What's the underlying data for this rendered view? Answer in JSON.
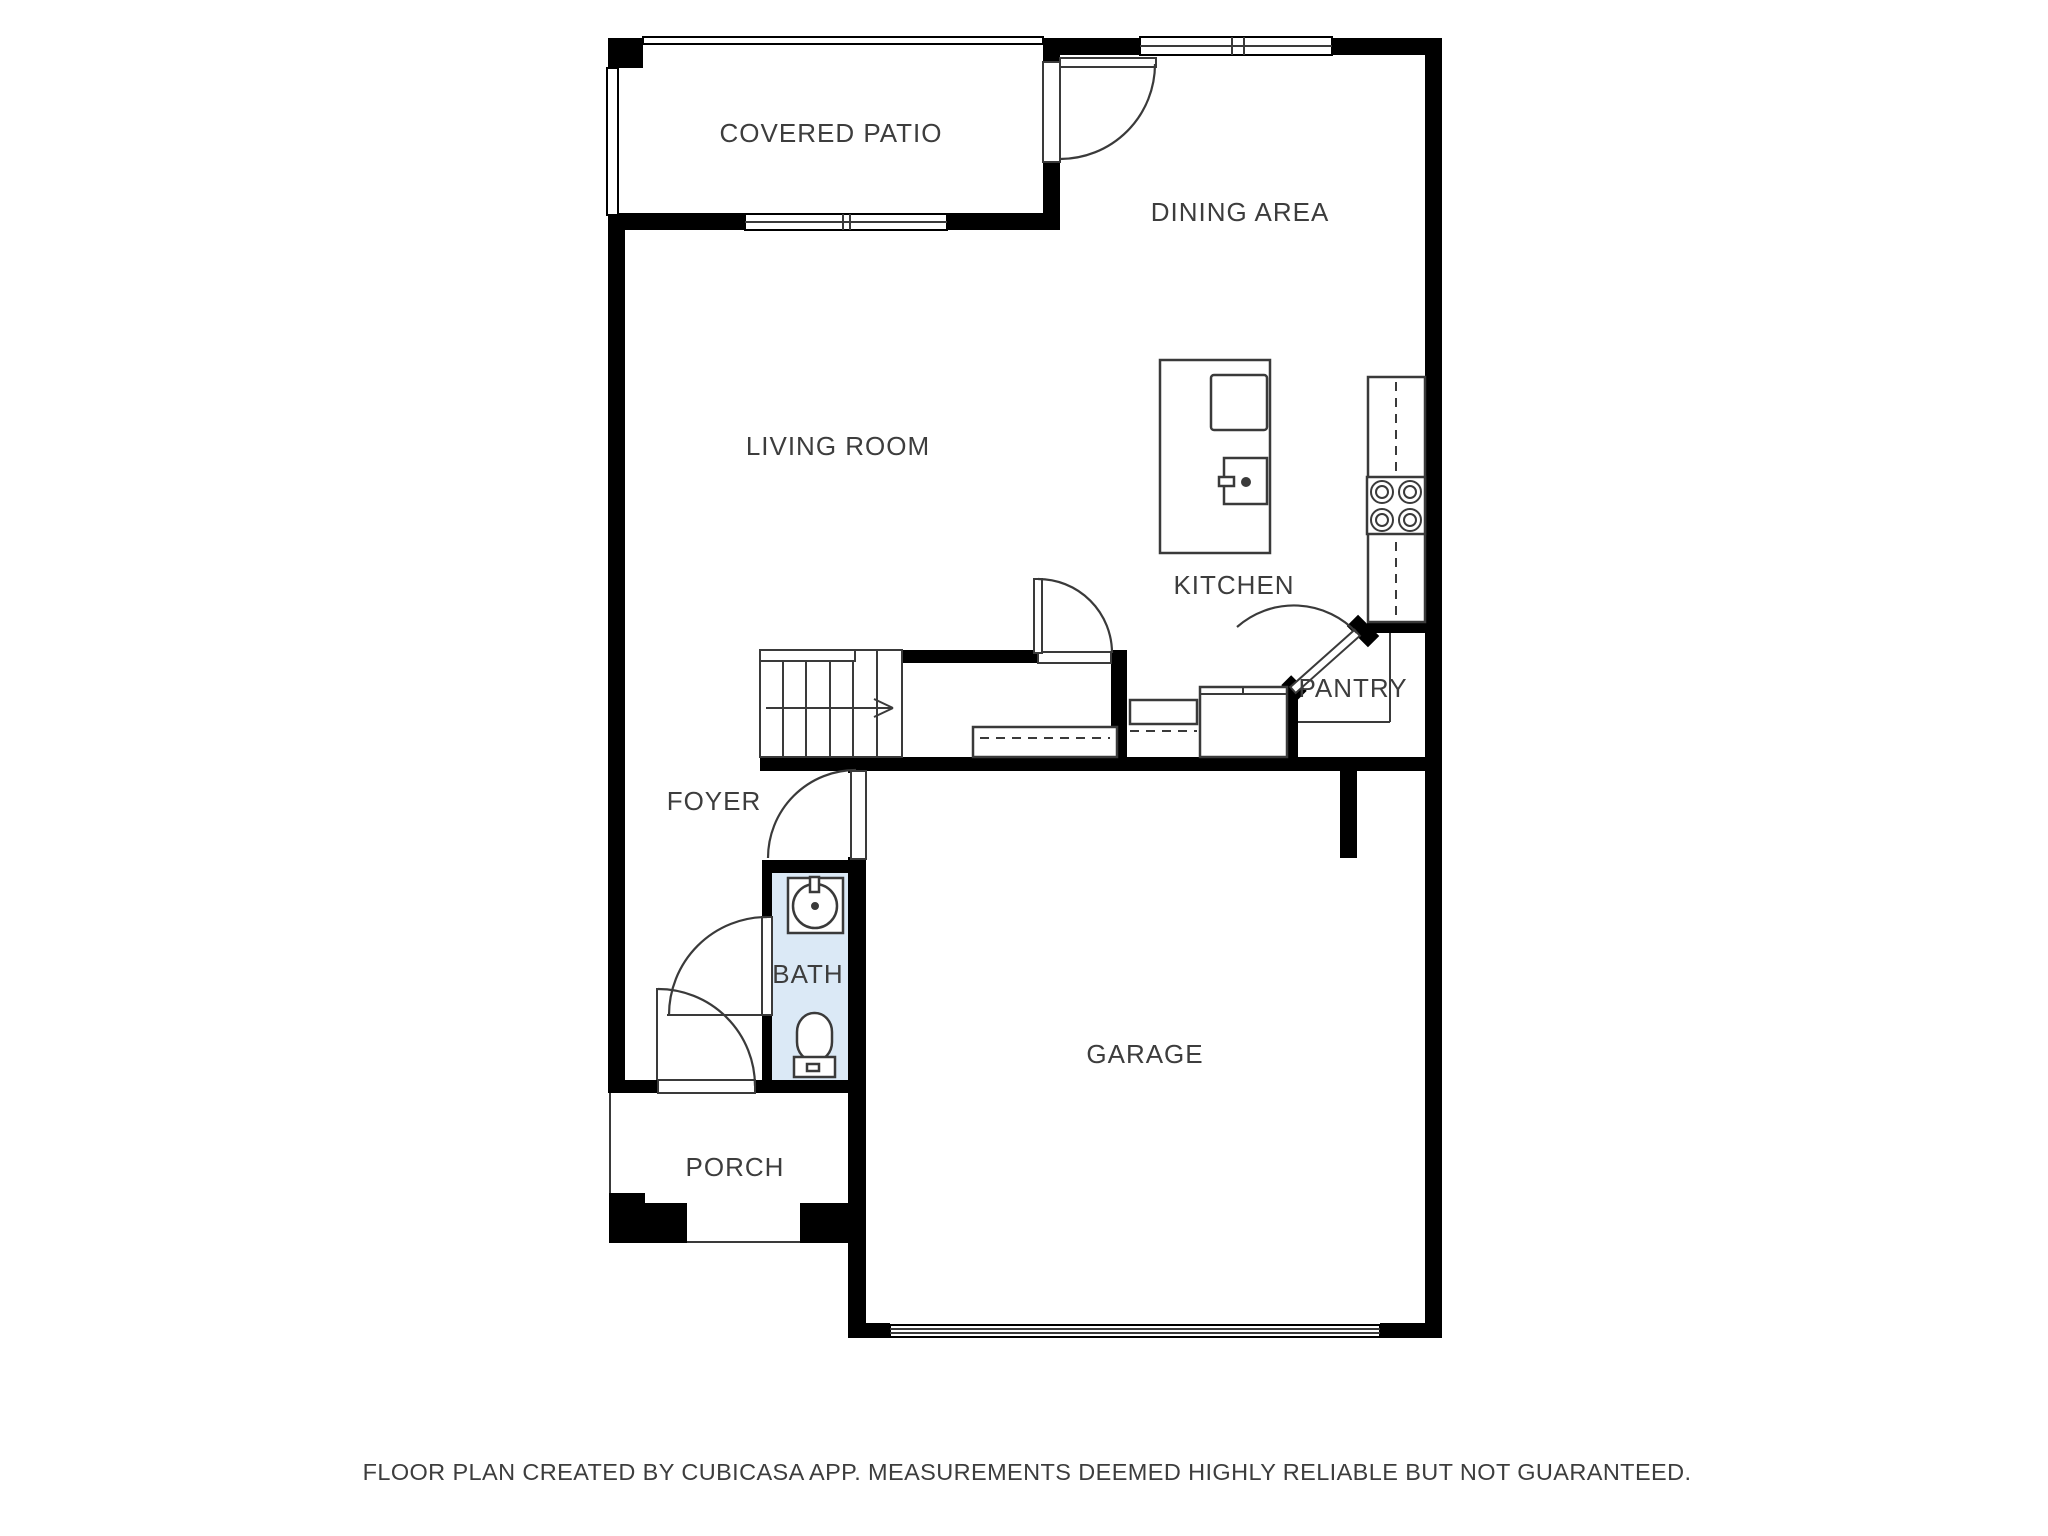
{
  "rooms": [
    {
      "id": "covered-patio",
      "label": "COVERED PATIO"
    },
    {
      "id": "dining-area",
      "label": "DINING AREA"
    },
    {
      "id": "living-room",
      "label": "LIVING ROOM"
    },
    {
      "id": "kitchen",
      "label": "KITCHEN"
    },
    {
      "id": "pantry",
      "label": "PANTRY"
    },
    {
      "id": "foyer",
      "label": "FOYER"
    },
    {
      "id": "bath",
      "label": "BATH"
    },
    {
      "id": "garage",
      "label": "GARAGE"
    },
    {
      "id": "porch",
      "label": "PORCH"
    }
  ],
  "footer": {
    "disclaimer": "FLOOR PLAN CREATED BY CUBICASA APP. MEASUREMENTS DEEMED HIGHLY RELIABLE BUT NOT GUARANTEED."
  },
  "colors": {
    "wall": "#000000",
    "bath_fill": "#dbe9f6",
    "line": "#3a3a3a",
    "label_text": "#3d3d3d",
    "background": "#ffffff"
  }
}
